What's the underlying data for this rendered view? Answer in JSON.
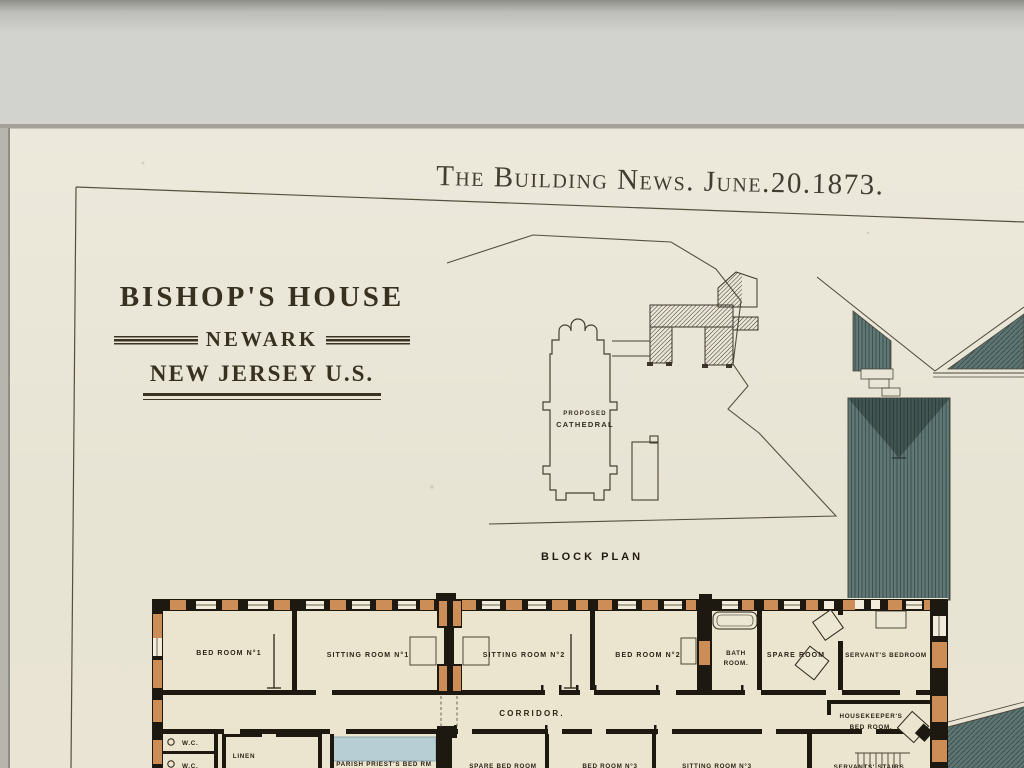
{
  "colors": {
    "mat": "#d2d2ce",
    "mat_top_shadow": "#8f8f89",
    "paper": "#e9e5d6",
    "ink": "#4a4434",
    "wall_black": "#1e1910",
    "wall_orange": "#cd8d56",
    "room_cream": "#ebe5cf",
    "roof_teal": "#5f7775",
    "roof_teal_dark": "#415553",
    "water_blue": "#b8ced5"
  },
  "header": {
    "title": "The Building News. June.20.1873."
  },
  "title_block": {
    "line1": "BISHOP'S HOUSE",
    "line2": "NEWARK",
    "line3": "NEW JERSEY U.S."
  },
  "block_plan": {
    "cathedral_line1": "PROPOSED",
    "cathedral_line2": "CATHEDRAL",
    "caption": "BLOCK PLAN"
  },
  "floor_plan": {
    "corridor": "CORRIDOR.",
    "rooms": {
      "bed1": "BED ROOM N°1",
      "sitting1": "SITTING ROOM N°1",
      "sitting2": "SITTING ROOM N°2",
      "bed2": "BED ROOM N°2",
      "bath_line1": "BATH",
      "bath_line2": "ROOM.",
      "spare": "SPARE ROOM",
      "servants_bedroom": "SERVANT'S BEDROOM",
      "wc_upper": "W.C.",
      "wc_lower": "W.C.",
      "linen": "LINEN",
      "parish": "PARISH PRIEST'S BED RM",
      "spare_bed": "SPARE BED ROOM",
      "bed3": "BED ROOM N°3",
      "sitting3": "SITTING ROOM N°3",
      "housekeeper_line1": "HOUSEKEEPER'S",
      "housekeeper_line2": "BED ROOM.",
      "servants_stairs": "SERVANTS' STAIRS"
    }
  }
}
